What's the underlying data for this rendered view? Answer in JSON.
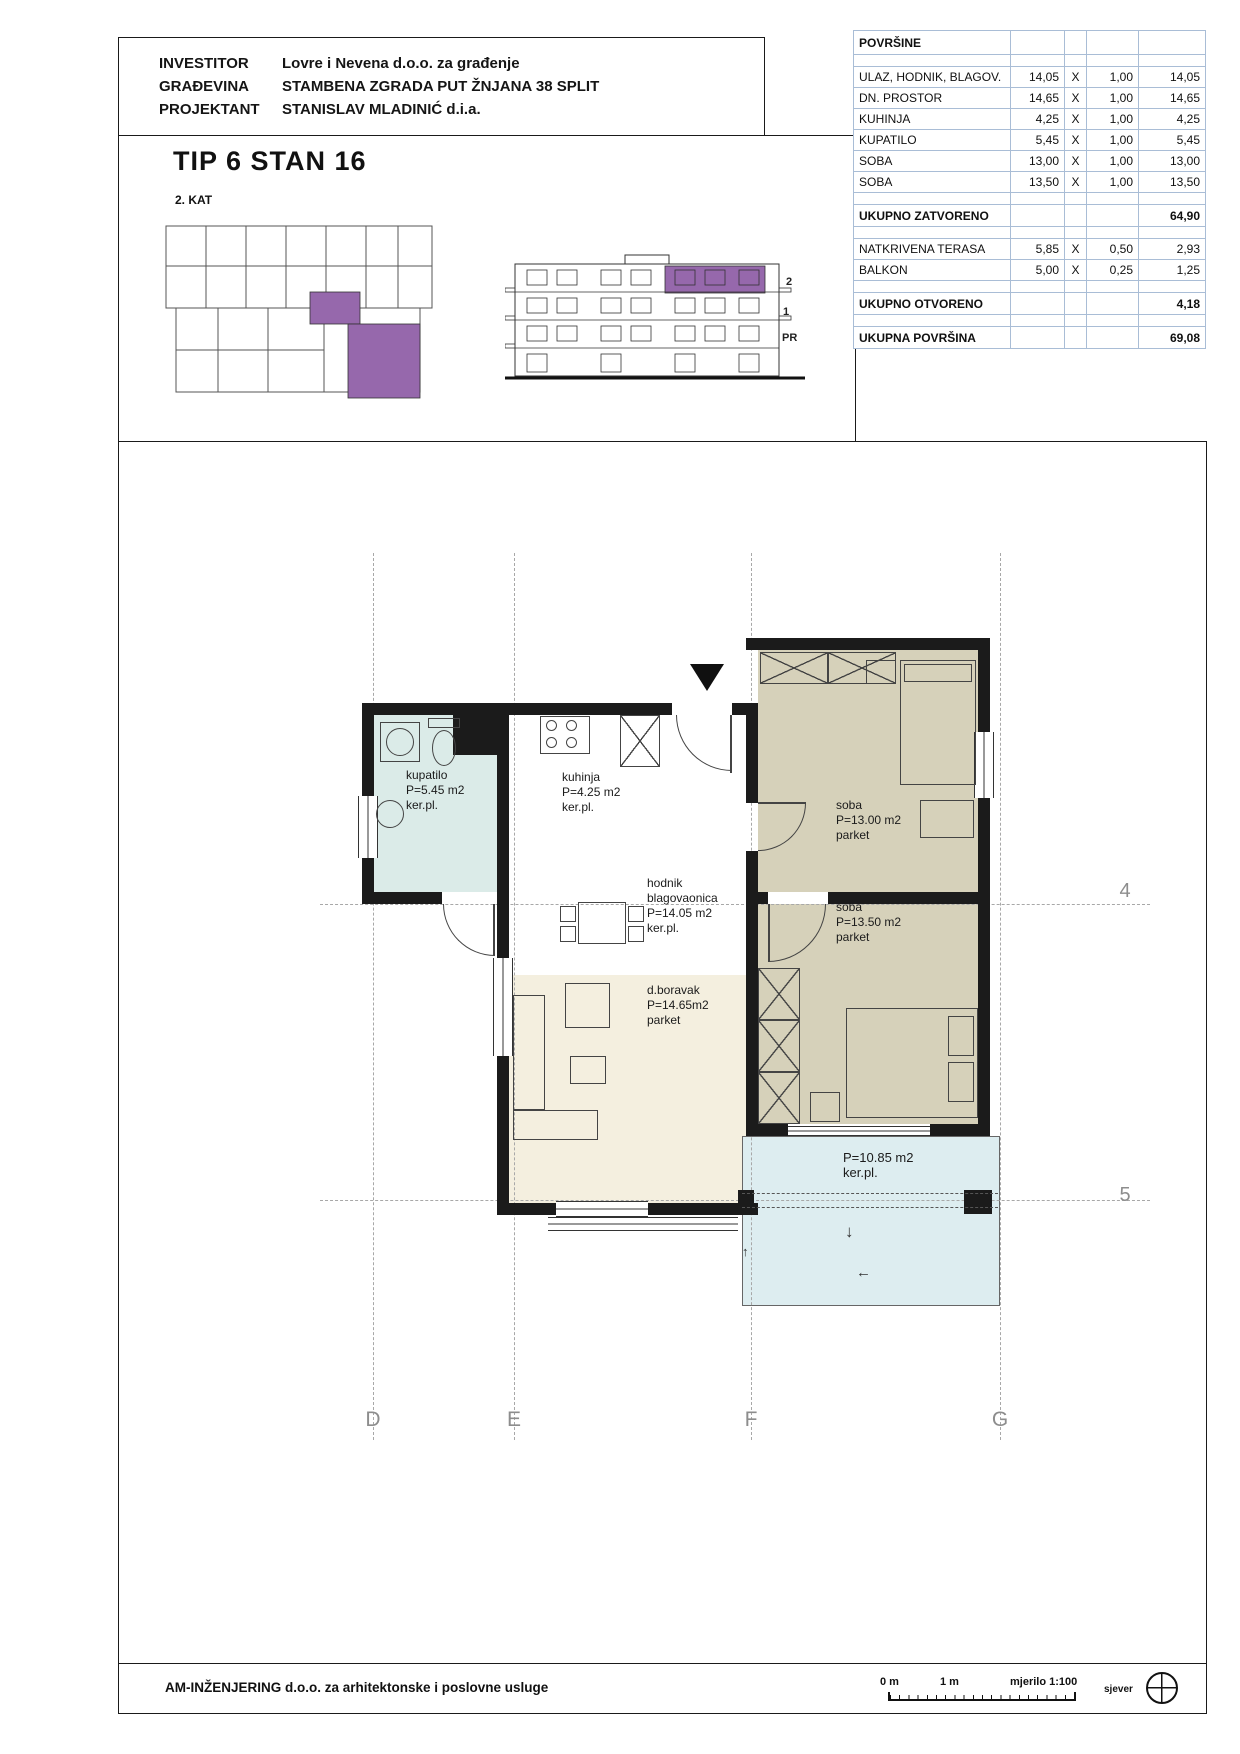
{
  "header": {
    "rows": [
      {
        "label": "INVESTITOR",
        "value": "Lovre i Nevena d.o.o. za građenje"
      },
      {
        "label": "GRAĐEVINA",
        "value": "STAMBENA ZGRADA PUT ŽNJANA 38 SPLIT"
      },
      {
        "label": "PROJEKTANT",
        "value": "STANISLAV MLADINIĆ d.i.a."
      }
    ]
  },
  "title_block": {
    "title": "TIP 6 STAN 16",
    "floor": "2. KAT"
  },
  "elevation": {
    "floor_labels": [
      "2",
      "1",
      "PR"
    ]
  },
  "areas_table": {
    "rows": [
      {
        "label": "POVRŠINE",
        "area": "",
        "x": "",
        "factor": "",
        "total": ""
      },
      {
        "label": "",
        "area": "",
        "x": "",
        "factor": "",
        "total": ""
      },
      {
        "label": "ULAZ, HODNIK, BLAGOV.",
        "area": "14,05",
        "x": "X",
        "factor": "1,00",
        "total": "14,05"
      },
      {
        "label": "DN. PROSTOR",
        "area": "14,65",
        "x": "X",
        "factor": "1,00",
        "total": "14,65"
      },
      {
        "label": "KUHINJA",
        "area": "4,25",
        "x": "X",
        "factor": "1,00",
        "total": "4,25"
      },
      {
        "label": "KUPATILO",
        "area": "5,45",
        "x": "X",
        "factor": "1,00",
        "total": "5,45"
      },
      {
        "label": "SOBA",
        "area": "13,00",
        "x": "X",
        "factor": "1,00",
        "total": "13,00"
      },
      {
        "label": "SOBA",
        "area": "13,50",
        "x": "X",
        "factor": "1,00",
        "total": "13,50"
      },
      {
        "label": "",
        "area": "",
        "x": "",
        "factor": "",
        "total": ""
      },
      {
        "label": "UKUPNO ZATVORENO",
        "area": "",
        "x": "",
        "factor": "",
        "total": "64,90"
      },
      {
        "label": "",
        "area": "",
        "x": "",
        "factor": "",
        "total": ""
      },
      {
        "label": "NATKRIVENA TERASA",
        "area": "5,85",
        "x": "X",
        "factor": "0,50",
        "total": "2,93"
      },
      {
        "label": "BALKON",
        "area": "5,00",
        "x": "X",
        "factor": "0,25",
        "total": "1,25"
      },
      {
        "label": "",
        "area": "",
        "x": "",
        "factor": "",
        "total": ""
      },
      {
        "label": "UKUPNO OTVORENO",
        "area": "",
        "x": "",
        "factor": "",
        "total": "4,18"
      },
      {
        "label": "",
        "area": "",
        "x": "",
        "factor": "",
        "total": ""
      },
      {
        "label": "UKUPNA POVRŠINA",
        "area": "",
        "x": "",
        "factor": "",
        "total": "69,08"
      }
    ]
  },
  "plan": {
    "rooms": {
      "kupatilo": {
        "lines": [
          "kupatilo",
          "P=5.45 m2",
          "ker.pl."
        ]
      },
      "kuhinja": {
        "lines": [
          "kuhinja",
          "P=4.25 m2",
          "ker.pl."
        ]
      },
      "hodnik": {
        "lines": [
          "hodnik",
          "blagovaonica",
          "P=14.05 m2",
          "ker.pl."
        ]
      },
      "dnevni_boravak": {
        "lines": [
          "d.boravak",
          "P=14.65m2",
          "parket"
        ]
      },
      "soba1": {
        "lines": [
          "soba",
          "P=13.00 m2",
          "parket"
        ]
      },
      "soba2": {
        "lines": [
          "soba",
          "P=13.50 m2",
          "parket"
        ]
      },
      "terasa": {
        "lines": [
          "P=10.85 m2",
          "ker.pl."
        ]
      }
    },
    "grid": {
      "columns": [
        "D",
        "E",
        "F",
        "G"
      ],
      "rows": [
        "4",
        "5"
      ]
    },
    "arrows": {
      "down": "↓",
      "left": "←",
      "up": "↑"
    }
  },
  "footer": {
    "company": "AM-INŽENJERING d.o.o. za arhitektonske i poslovne usluge",
    "scale": {
      "zero": "0 m",
      "one": "1 m",
      "ratio": "mjerilo 1:100"
    },
    "north_label": "sjever"
  },
  "colors": {
    "highlight_purple": "#9668ac",
    "room_tan": "#d6d1ba",
    "room_cream": "#f4efdf",
    "room_cyan": "#dbebe8",
    "terrace_cyan": "#ddedf0",
    "table_border_blue": "#a9bdd6"
  }
}
